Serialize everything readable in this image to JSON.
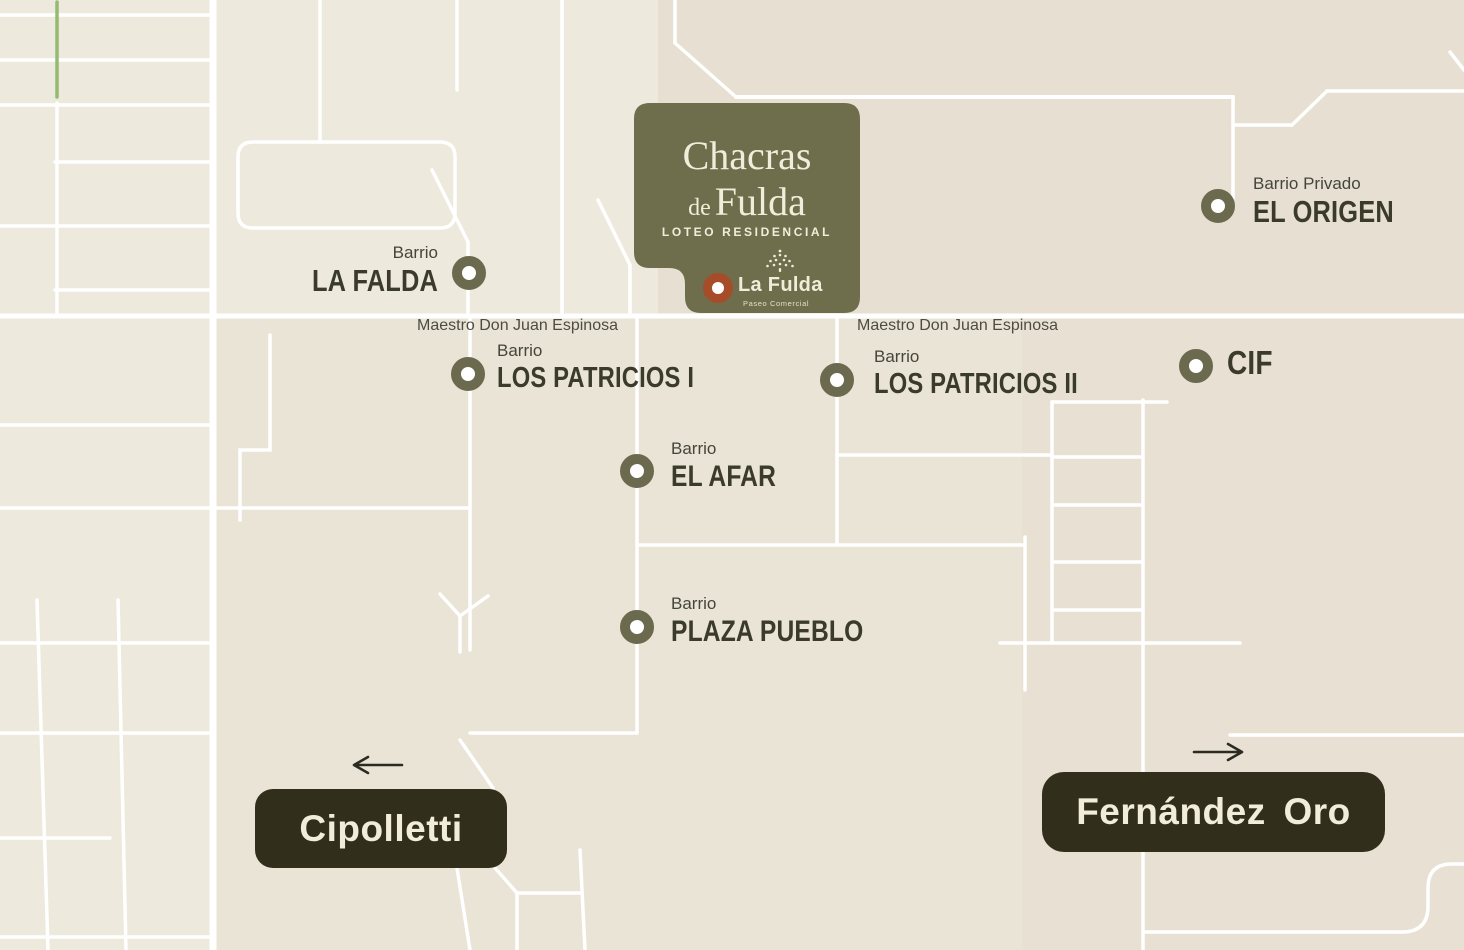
{
  "theme": {
    "bg": "#EBE5D8",
    "bg-light": "#EEE9DD",
    "bg-mid": "#EAE4D6",
    "bg-dark": "#E7E0D2",
    "bg-dark2": "#E8E1D3",
    "road": "#FFFFFF",
    "green-road": "#94BB72",
    "card-bg": "#6E6D4C",
    "cream": "#F2EDDA",
    "marker": "#6B6A4F",
    "rust": "#A64C29",
    "dark-box": "#312F1B",
    "label": "#3B3B2C",
    "label-soft": "#45453A",
    "street": "#4C4C41",
    "arrow": "#2C2B23"
  },
  "card": {
    "title_word1": "Chacras",
    "title_word2_small": "de",
    "title_word2": "Fulda",
    "subtitle": "LOTEO RESIDENCIAL",
    "brand_name": "La Fulda",
    "brand_tagline": "Paseo Comercial"
  },
  "streets": {
    "left": "Maestro Don Juan Espinosa",
    "right": "Maestro Don Juan Espinosa"
  },
  "locations": [
    {
      "id": "la-falda",
      "prefix": "Barrio",
      "name": "LA FALDA"
    },
    {
      "id": "el-origen",
      "prefix": "Barrio Privado",
      "name": "EL ORIGEN"
    },
    {
      "id": "los-patricios-1",
      "prefix": "Barrio",
      "name": "LOS PATRICIOS I"
    },
    {
      "id": "los-patricios-2",
      "prefix": "Barrio",
      "name": "LOS PATRICIOS II"
    },
    {
      "id": "cif",
      "prefix": "",
      "name": "CIF"
    },
    {
      "id": "el-afar",
      "prefix": "Barrio",
      "name": "EL AFAR"
    },
    {
      "id": "plaza-pueblo",
      "prefix": "Barrio",
      "name": "PLAZA PUEBLO"
    }
  ],
  "destinations": [
    {
      "id": "cipolletti",
      "name": "Cipolletti",
      "direction": "left"
    },
    {
      "id": "fernandez-oro",
      "name": "Fernández Oro",
      "direction": "right"
    }
  ]
}
